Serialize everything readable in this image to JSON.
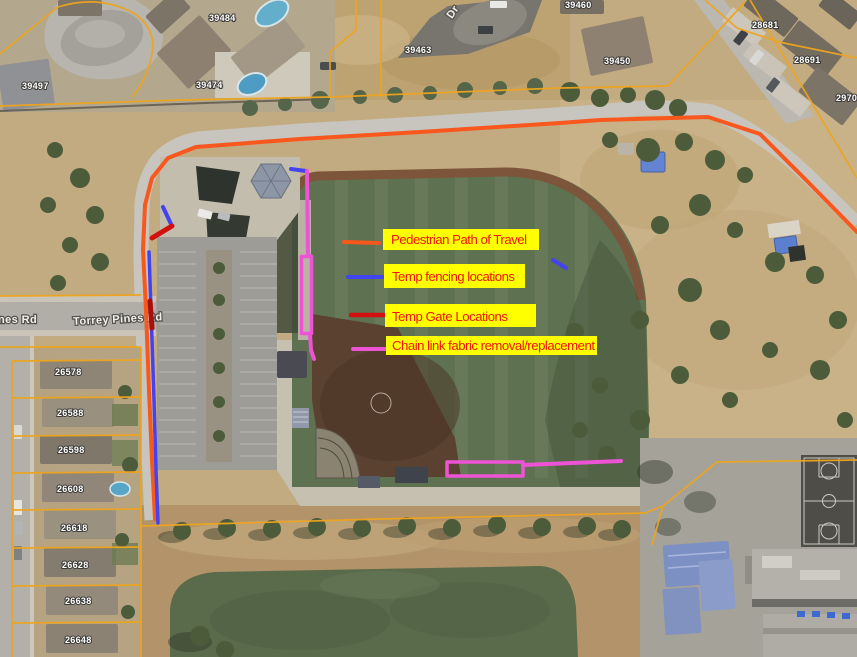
{
  "title": "Aerial site plan with construction staging annotations",
  "legend": {
    "box_color": "#ffff00",
    "text_color": "#ee1509",
    "items": [
      {
        "key": "pedestrian-path",
        "label": "Pedestrian Path of Travel",
        "color": "#f8571d"
      },
      {
        "key": "temp-fencing",
        "label": "Temp fencing locations",
        "color": "#4343ef"
      },
      {
        "key": "temp-gates",
        "label": "Temp Gate Locations",
        "color": "#d21010"
      },
      {
        "key": "chain-link",
        "label": "Chain link fabric removal/replacement",
        "color": "#ef53d5"
      }
    ]
  },
  "streets": {
    "torrey_pines": "Torrey Pines Rd",
    "nes_rd": "nes Rd",
    "dr": "Dr"
  },
  "parcels": {
    "labels": [
      "39497",
      "39484",
      "39474",
      "39463",
      "39460",
      "39450",
      "28681",
      "28691",
      "2970",
      "26578",
      "26588",
      "26598",
      "26608",
      "26618",
      "26628",
      "26638",
      "26648"
    ]
  }
}
